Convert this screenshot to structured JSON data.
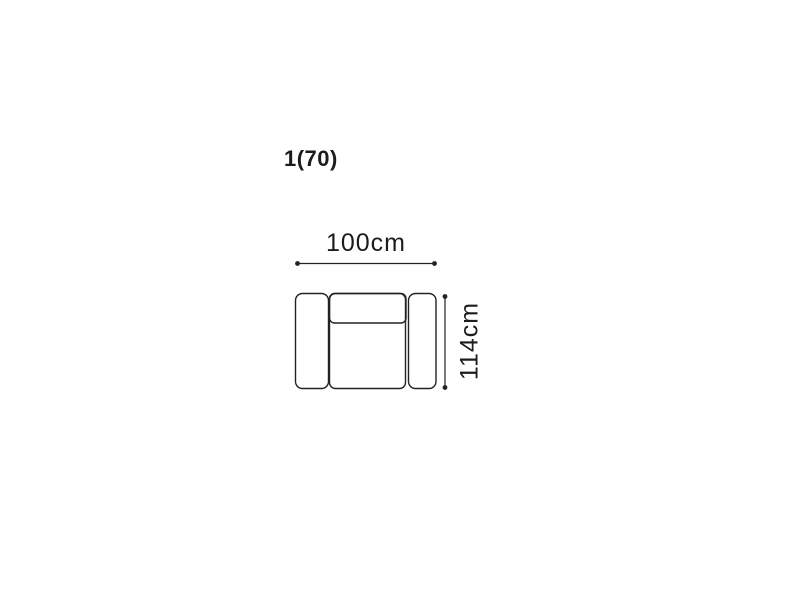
{
  "diagram": {
    "title": "1(70)",
    "item": "armchair-top-view",
    "width_label": "100cm",
    "height_label": "114cm",
    "colors": {
      "background": "#ffffff",
      "line": "#232323",
      "text": "#1c1c1c"
    }
  }
}
